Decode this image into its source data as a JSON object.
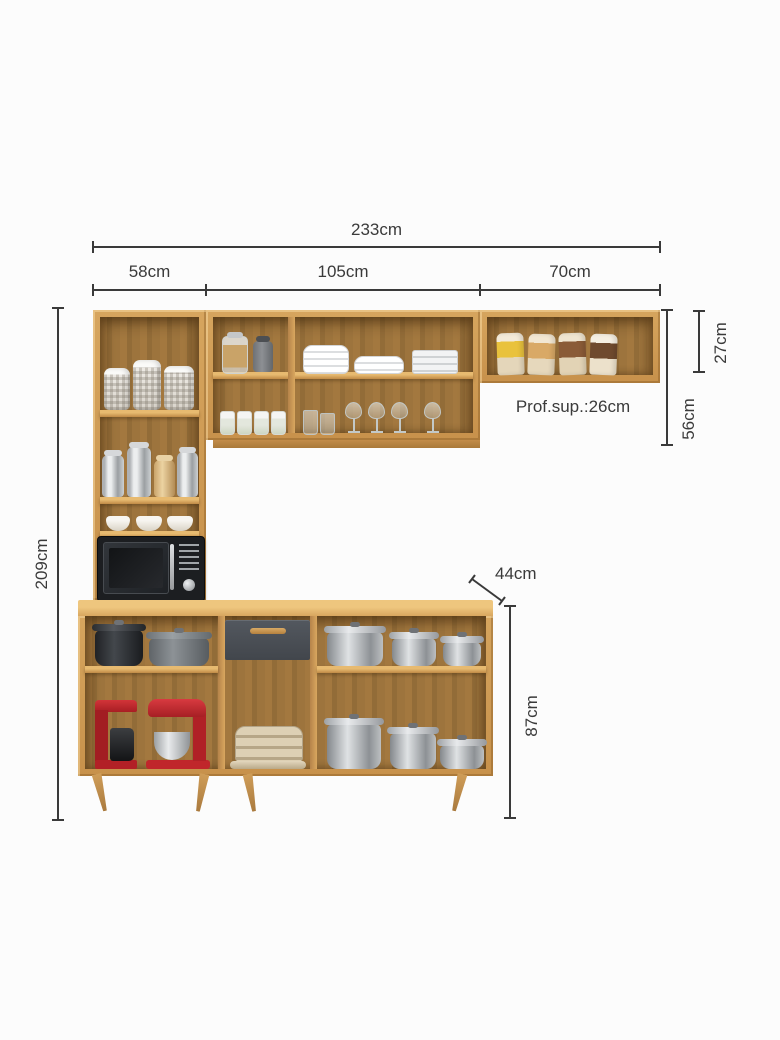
{
  "dims": {
    "total_width": "233cm",
    "section_left_width": "58cm",
    "section_middle_width": "105cm",
    "section_right_width": "70cm",
    "total_height": "209cm",
    "top_shelf_height": "27cm",
    "wall_cabinet_height": "56cm",
    "upper_depth_note": "Prof.sup.:26cm",
    "base_depth": "44cm",
    "base_height": "87cm"
  },
  "colors": {
    "background": "#fcfcfc",
    "dimension_line": "#3a3a3a",
    "wood_frame": "#cd9a55",
    "wood_interior": "#9a7140",
    "countertop": "#e0b169",
    "drawer_front": "#484d53",
    "drawer_handle": "#c29050",
    "microwave_body": "#1c1e21",
    "appliance_red": "#c3272b",
    "steel": "#a8abae"
  }
}
